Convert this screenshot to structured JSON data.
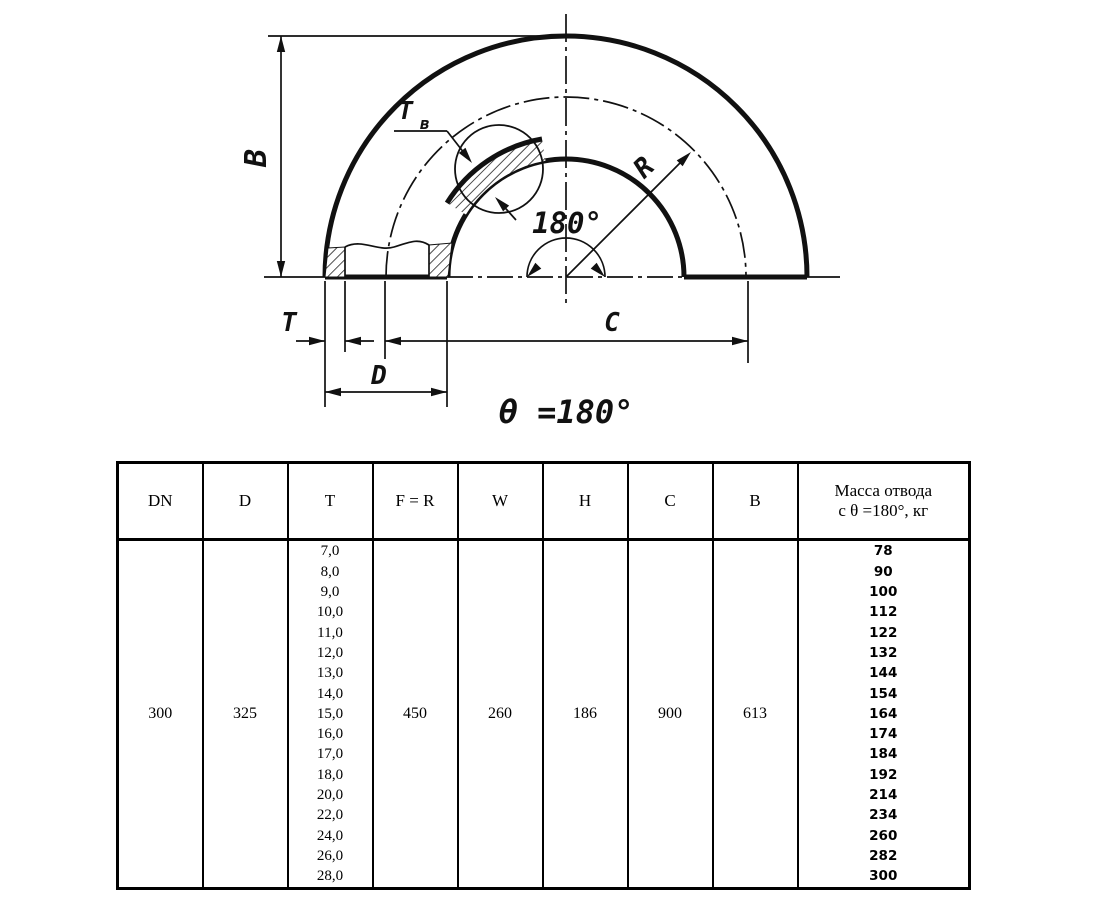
{
  "diagram": {
    "dim_b": "B",
    "dim_t": "T",
    "dim_tv_main": "T",
    "dim_tv_sub": "в",
    "dim_d": "D",
    "dim_c": "C",
    "dim_r": "R",
    "angle_label": "180°",
    "theta_label": "θ =180°"
  },
  "table": {
    "headers": [
      "DN",
      "D",
      "T",
      "F = R",
      "W",
      "H",
      "C",
      "B"
    ],
    "mass_header": {
      "line1": "Масса отвода",
      "line2": "с θ =180°, кг"
    },
    "dn": "300",
    "d": "325",
    "fr": "450",
    "w": "260",
    "h": "186",
    "c": "900",
    "b": "613",
    "t_values": [
      "7,0",
      "8,0",
      "9,0",
      "10,0",
      "11,0",
      "12,0",
      "13,0",
      "14,0",
      "15,0",
      "16,0",
      "17,0",
      "18,0",
      "20,0",
      "22,0",
      "24,0",
      "26,0",
      "28,0"
    ],
    "mass_values": [
      "78",
      "90",
      "100",
      "112",
      "122",
      "132",
      "144",
      "154",
      "164",
      "174",
      "184",
      "192",
      "214",
      "234",
      "260",
      "282",
      "300"
    ]
  }
}
